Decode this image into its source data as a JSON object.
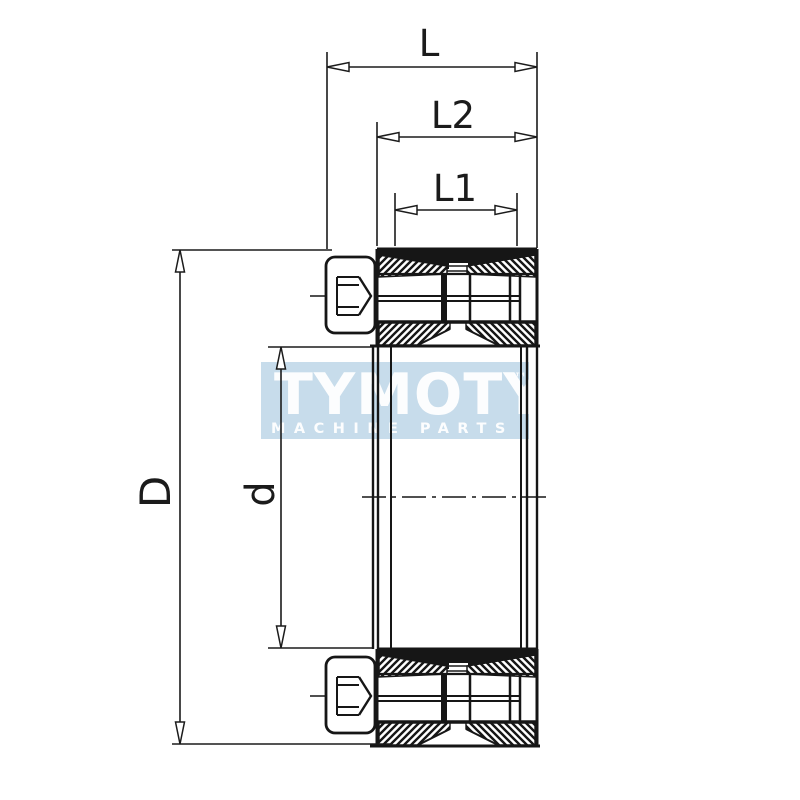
{
  "drawing": {
    "kind": "locking-assembly cross-section",
    "line_color": "#1b1b1b"
  },
  "dimensions": {
    "overall_length": "L",
    "collar_length": "L2",
    "sleeve_length": "L1",
    "outer_diameter": "D",
    "bore_diameter": "d"
  },
  "watermark": {
    "brand": "TYMOTY",
    "trademark": "™",
    "tagline": "MACHINE PARTS",
    "band_color": "#bdd6e8",
    "text_color": "#ffffff"
  }
}
